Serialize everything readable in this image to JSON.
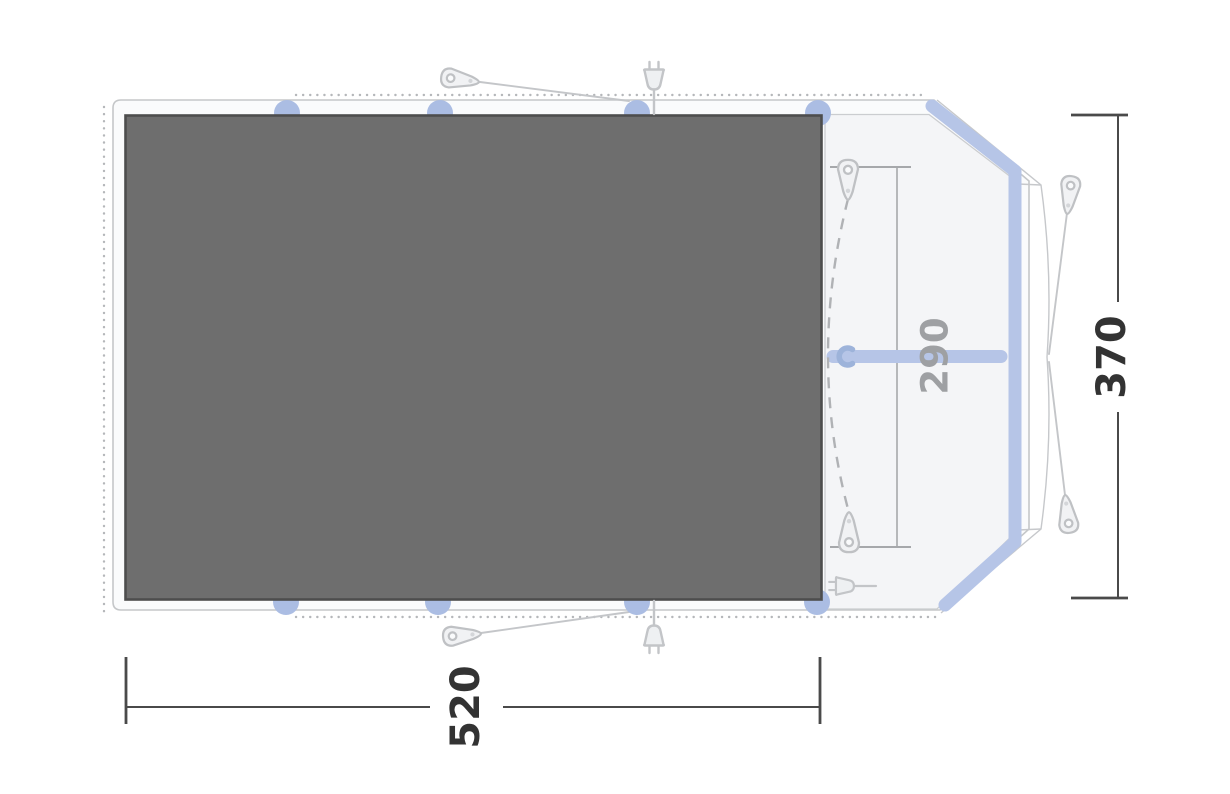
{
  "diagram": {
    "title": "tent-floorplan",
    "dimensions": {
      "width_label": "520",
      "depth_label": "370",
      "inner_depth_label": "290"
    },
    "colors": {
      "groundsheet_fill": "#6e6e6e",
      "groundsheet_border": "#4d4d4d",
      "pole_blue": "#b6c5e7",
      "pole_marker_blue": "#abbde3",
      "door_arrow_blue": "#9db3da",
      "outline_gray": "#c5c7c9",
      "dotted_gray": "#b5b7ba",
      "dimension_dark": "#3a3a3a",
      "dimension_gray": "#9ea0a3"
    },
    "icons": [
      "tent-peg-icon",
      "power-plug-icon",
      "door-swing-arrow-icon"
    ]
  }
}
